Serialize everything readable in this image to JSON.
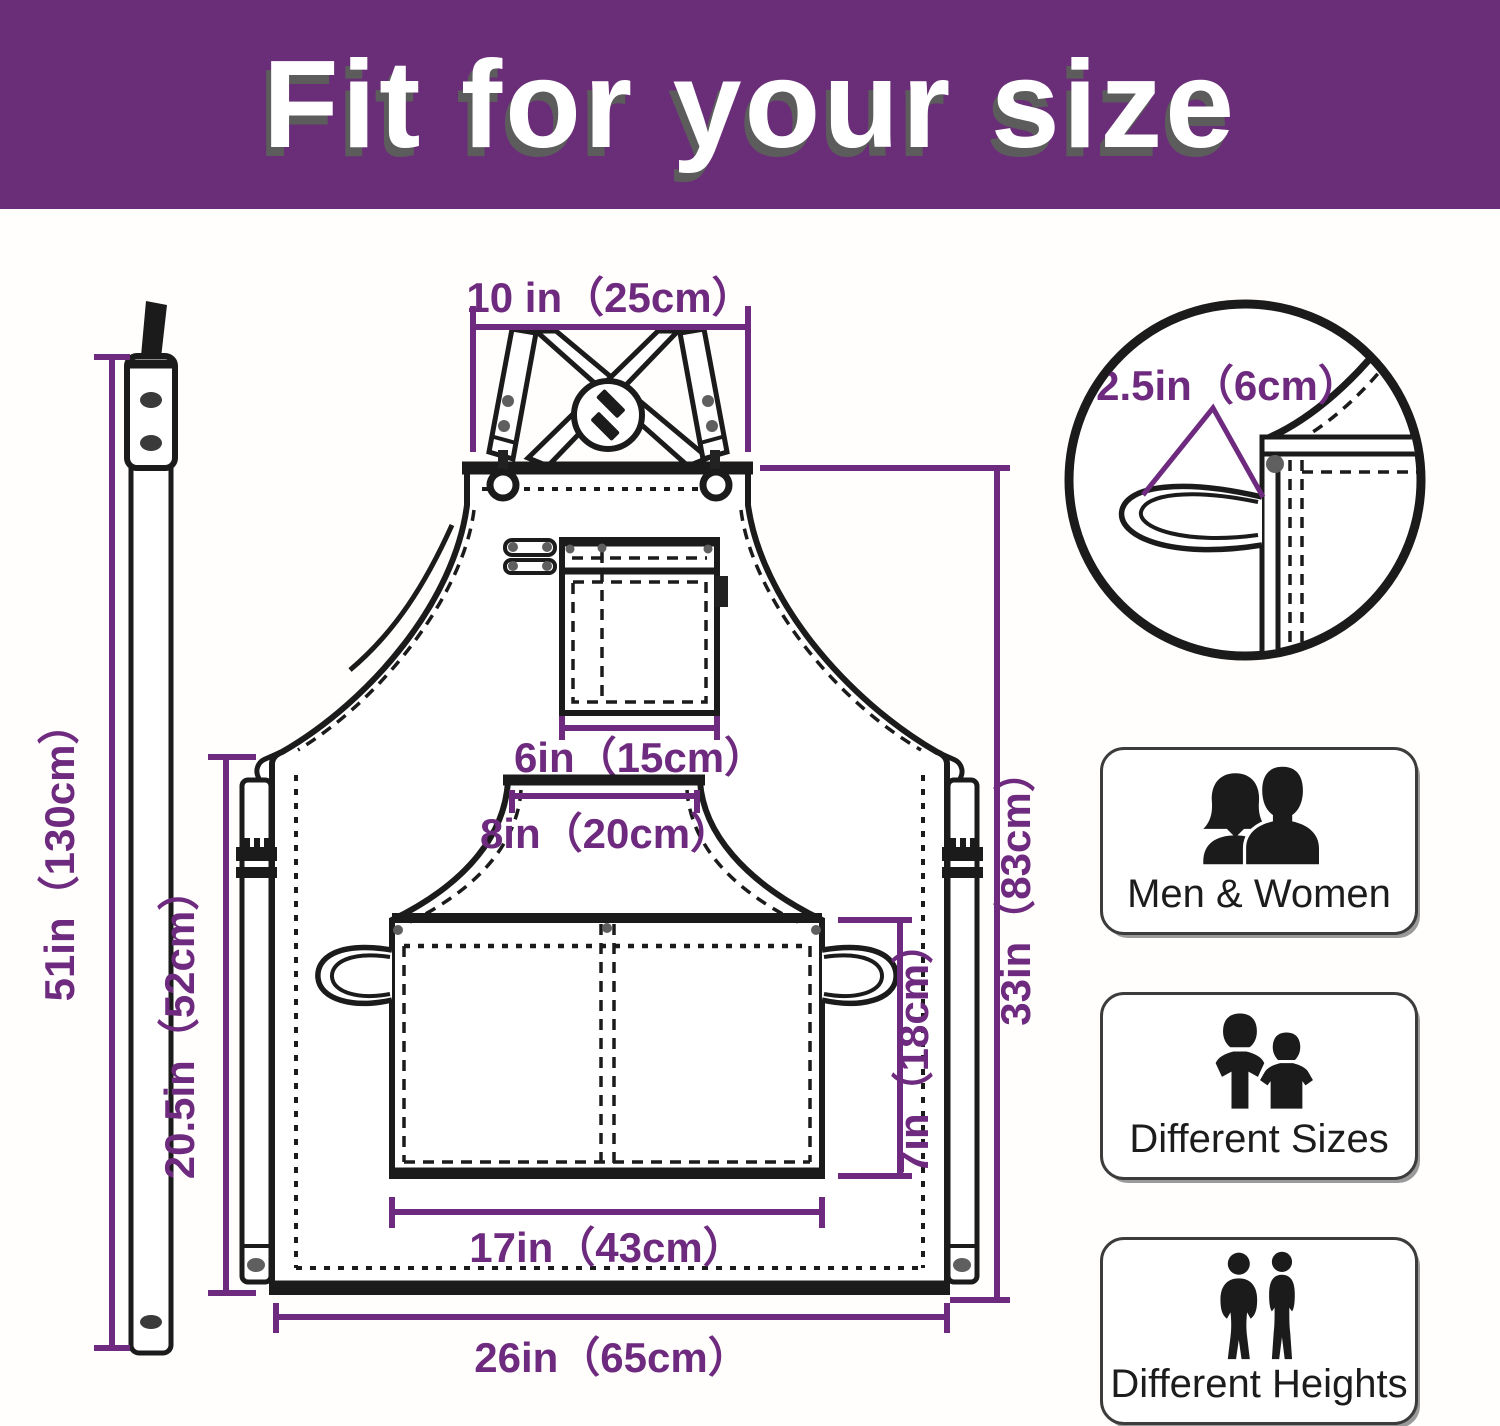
{
  "header": {
    "title": "Fit for your size"
  },
  "colors": {
    "header_bg": "#6A2E78",
    "dimension_purple": "#6E2A7E",
    "line_black": "#1B1B1B",
    "background": "#FFFFFF"
  },
  "apron": {
    "dimensions": {
      "top_width": "10 in（25cm）",
      "loop_width": "2.5in（6cm）",
      "chest_pocket_width": "6in（15cm）",
      "front_pocket_top_width": "8in（20cm）",
      "front_pocket_width": "17in（43cm）",
      "front_pocket_height": "7in（18cm）",
      "body_length": "33in（83cm）",
      "side_length": "20.5in（52cm）",
      "strap_length": "51in（130cm）",
      "bottom_width": "26in（65cm）"
    }
  },
  "features": [
    {
      "label": "Men & Women",
      "icon": "men-women-icon"
    },
    {
      "label": "Different Sizes",
      "icon": "different-sizes-icon"
    },
    {
      "label": "Different Heights",
      "icon": "different-heights-icon"
    }
  ]
}
